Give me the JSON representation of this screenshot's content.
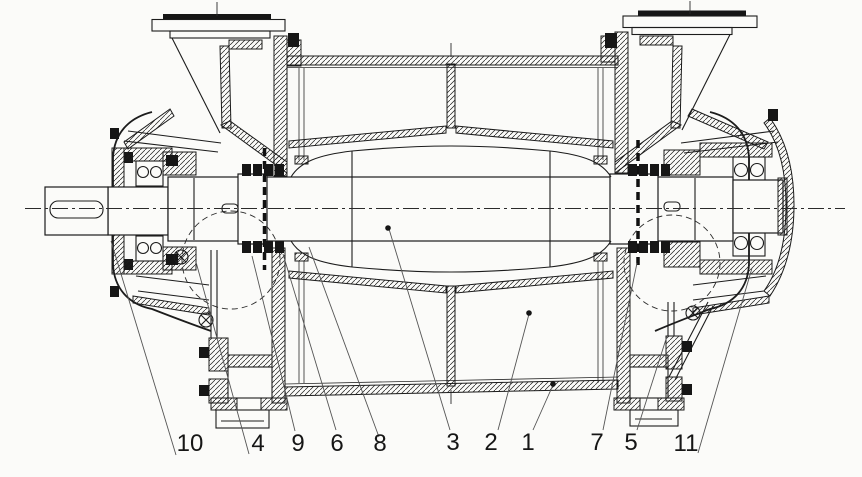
{
  "colors": {
    "ink": "#1c1c1c",
    "paper": "#fbfbf9",
    "leader": "#555555"
  },
  "callouts": {
    "items": [
      {
        "label": "10"
      },
      {
        "label": "4"
      },
      {
        "label": "9"
      },
      {
        "label": "6"
      },
      {
        "label": "8"
      },
      {
        "label": "3"
      },
      {
        "label": "2"
      },
      {
        "label": "1"
      },
      {
        "label": "7"
      },
      {
        "label": "5"
      },
      {
        "label": "11"
      }
    ]
  }
}
